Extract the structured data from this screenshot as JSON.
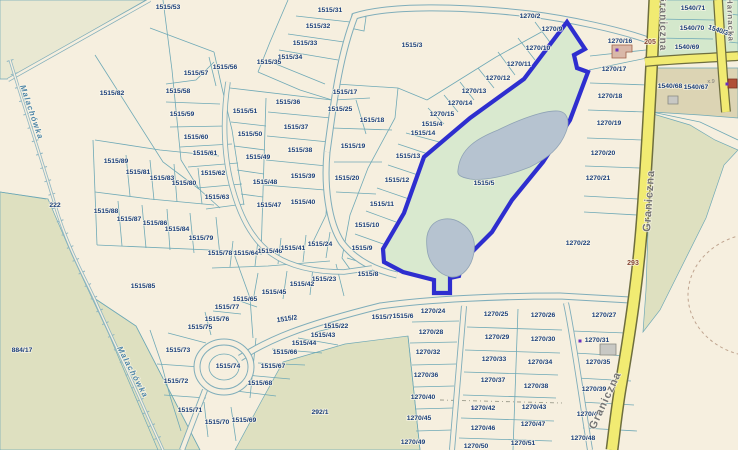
{
  "app": {
    "type": "cadastral-map-viewer",
    "selected_parcel": "1515/5"
  },
  "colors": {
    "background": "#f6efdf",
    "parcel_line": "#6fa9b6",
    "label_navy": "#1b3f7b",
    "label_ref": "#8a4a3a",
    "label_sub": "#7a7a7a",
    "street_gray": "#757575",
    "water_label": "#4f86a8",
    "selection_blue": "#2e2ecf",
    "selection_fill": "#d9e9cf",
    "lake": "#b6c3d0",
    "olive_green": "#dee0c0",
    "light_green": "#d4e8cc",
    "tan_builtup": "#dcd4b4",
    "road_yellow": "#f1eb72",
    "road_yellow_casing": "#6e6e3e",
    "road_white_casing": "#7fadba",
    "building_tan": "#d9b8a8",
    "building_gray": "#c8c8c4",
    "building_red": "#b05038",
    "marker_purple": "#6a30c0",
    "contour_dash": "#c0a590"
  },
  "street_labels": [
    {
      "text": "Graniczna",
      "x": 660,
      "y": -6,
      "rot": 90,
      "size": 10,
      "kind": "street"
    },
    {
      "text": "Graniczna",
      "x": 650,
      "y": 232,
      "rot": -86,
      "size": 11,
      "kind": "street"
    },
    {
      "text": "Graniczna",
      "x": 595,
      "y": 430,
      "rot": -65,
      "size": 11,
      "kind": "street"
    },
    {
      "text": "Harnacka",
      "x": 727,
      "y": -2,
      "rot": 88,
      "size": 8,
      "kind": "street"
    },
    {
      "text": "Malachówka",
      "x": 20,
      "y": 86,
      "rot": 71,
      "size": 8,
      "kind": "water"
    },
    {
      "text": "Malachówka",
      "x": 117,
      "y": 348,
      "rot": 62,
      "size": 8,
      "kind": "water"
    }
  ],
  "ref_labels": [
    {
      "text": "205",
      "x": 650,
      "y": 42
    },
    {
      "text": "293",
      "x": 633,
      "y": 263
    }
  ],
  "sub_labels": [
    {
      "text": "x.9",
      "x": 711,
      "y": 83
    }
  ],
  "markers": [
    {
      "x": 617,
      "y": 50
    },
    {
      "x": 580,
      "y": 341
    },
    {
      "x": 473,
      "y": 408
    },
    {
      "x": 727,
      "y": 84
    }
  ],
  "parcel_labels": [
    [
      "1515/53",
      168,
      7
    ],
    [
      "1515/31",
      330,
      10
    ],
    [
      "1515/32",
      318,
      26
    ],
    [
      "1515/33",
      305,
      43
    ],
    [
      "1515/34",
      290,
      57
    ],
    [
      "1515/35",
      269,
      62
    ],
    [
      "1515/56",
      225,
      67
    ],
    [
      "1515/57",
      196,
      73
    ],
    [
      "1515/58",
      178,
      91
    ],
    [
      "1515/59",
      182,
      114
    ],
    [
      "1515/60",
      196,
      137
    ],
    [
      "1515/61",
      205,
      153
    ],
    [
      "1515/62",
      213,
      173
    ],
    [
      "1515/63",
      217,
      197
    ],
    [
      "1515/82",
      112,
      93
    ],
    [
      "222",
      55,
      205
    ],
    [
      "884/17",
      22,
      350
    ],
    [
      "1515/51",
      245,
      111
    ],
    [
      "1515/50",
      250,
      134
    ],
    [
      "1515/49",
      258,
      157
    ],
    [
      "1515/48",
      265,
      182
    ],
    [
      "1515/47",
      269,
      205
    ],
    [
      "1515/36",
      288,
      102
    ],
    [
      "1515/37",
      296,
      127
    ],
    [
      "1515/38",
      300,
      150
    ],
    [
      "1515/39",
      303,
      176
    ],
    [
      "1515/40",
      303,
      202
    ],
    [
      "1515/17",
      345,
      92
    ],
    [
      "1515/25",
      340,
      109
    ],
    [
      "1515/18",
      372,
      120
    ],
    [
      "1515/19",
      353,
      146
    ],
    [
      "1515/20",
      347,
      178
    ],
    [
      "1515/3",
      412,
      45
    ],
    [
      "1515/4",
      432,
      124
    ],
    [
      "1515/14",
      423,
      133
    ],
    [
      "1515/13",
      408,
      156
    ],
    [
      "1515/12",
      397,
      180
    ],
    [
      "1515/11",
      382,
      204
    ],
    [
      "1515/10",
      367,
      225
    ],
    [
      "1515/9",
      362,
      248
    ],
    [
      "1515/8",
      368,
      274
    ],
    [
      "1270/2",
      530,
      16
    ],
    [
      "1270/9",
      552,
      29
    ],
    [
      "1270/10",
      538,
      48
    ],
    [
      "1270/11",
      519,
      64
    ],
    [
      "1270/12",
      498,
      78
    ],
    [
      "1270/13",
      474,
      91
    ],
    [
      "1270/14",
      460,
      103
    ],
    [
      "1270/15",
      442,
      114
    ],
    [
      "1270/16",
      620,
      41
    ],
    [
      "1270/17",
      614,
      69
    ],
    [
      "1270/18",
      610,
      96
    ],
    [
      "1270/19",
      609,
      123
    ],
    [
      "1270/20",
      603,
      153
    ],
    [
      "1270/21",
      598,
      178
    ],
    [
      "1270/22",
      578,
      243
    ],
    [
      "1515/5",
      484,
      183
    ],
    [
      "1515/89",
      116,
      161
    ],
    [
      "1515/81",
      138,
      172
    ],
    [
      "1515/83",
      162,
      178
    ],
    [
      "1515/80",
      184,
      183
    ],
    [
      "1515/88",
      106,
      211
    ],
    [
      "1515/87",
      129,
      219
    ],
    [
      "1515/86",
      155,
      223
    ],
    [
      "1515/84",
      177,
      229
    ],
    [
      "1515/79",
      201,
      238
    ],
    [
      "1515/78",
      220,
      253
    ],
    [
      "1515/64",
      246,
      253
    ],
    [
      "1515/46",
      270,
      251
    ],
    [
      "1515/41",
      293,
      248
    ],
    [
      "1515/24",
      320,
      244
    ],
    [
      "1515/23",
      324,
      279
    ],
    [
      "1515/42",
      302,
      284
    ],
    [
      "1515/45",
      274,
      292
    ],
    [
      "1515/65",
      245,
      299
    ],
    [
      "1515/77",
      227,
      307
    ],
    [
      "1515/76",
      217,
      319
    ],
    [
      "1515/75",
      200,
      327
    ],
    [
      "1515/85",
      143,
      286
    ],
    [
      "1515/2",
      287,
      319,
      -8
    ],
    [
      "1515/22",
      336,
      326
    ],
    [
      "1515/43",
      323,
      335
    ],
    [
      "1515/44",
      304,
      343
    ],
    [
      "1515/66",
      285,
      352
    ],
    [
      "1515/67",
      273,
      366
    ],
    [
      "1515/68",
      260,
      383
    ],
    [
      "1515/73",
      178,
      350
    ],
    [
      "1515/74",
      228,
      366
    ],
    [
      "1515/72",
      176,
      381
    ],
    [
      "1515/71",
      190,
      410
    ],
    [
      "1515/70",
      217,
      422
    ],
    [
      "1515/69",
      244,
      420
    ],
    [
      "292/1",
      320,
      412
    ],
    [
      "1515/7",
      382,
      317
    ],
    [
      "1515/6",
      403,
      316
    ],
    [
      "1270/24",
      433,
      311
    ],
    [
      "1270/28",
      431,
      332
    ],
    [
      "1270/32",
      428,
      352
    ],
    [
      "1270/36",
      426,
      375
    ],
    [
      "1270/40",
      423,
      397
    ],
    [
      "1270/45",
      419,
      418
    ],
    [
      "1270/49",
      413,
      442
    ],
    [
      "1270/25",
      496,
      314
    ],
    [
      "1270/26",
      543,
      315
    ],
    [
      "1270/29",
      497,
      337
    ],
    [
      "1270/30",
      543,
      339
    ],
    [
      "1270/33",
      494,
      359
    ],
    [
      "1270/34",
      540,
      362
    ],
    [
      "1270/37",
      493,
      380
    ],
    [
      "1270/38",
      536,
      386
    ],
    [
      "1270/42",
      483,
      408
    ],
    [
      "1270/43",
      534,
      407
    ],
    [
      "1270/46",
      483,
      428
    ],
    [
      "1270/47",
      533,
      424
    ],
    [
      "1270/50",
      476,
      446
    ],
    [
      "1270/51",
      523,
      443
    ],
    [
      "1270/27",
      604,
      315
    ],
    [
      "1270/31",
      597,
      340
    ],
    [
      "1270/35",
      598,
      362
    ],
    [
      "1270/39",
      594,
      389
    ],
    [
      "1270/44",
      589,
      414
    ],
    [
      "1270/48",
      583,
      438
    ],
    [
      "1540/71",
      693,
      8
    ],
    [
      "1540/70",
      692,
      28
    ],
    [
      "1540/38",
      720,
      31,
      18
    ],
    [
      "1540/69",
      687,
      47
    ],
    [
      "1540/68",
      670,
      86
    ],
    [
      "1540/67",
      696,
      87
    ]
  ]
}
